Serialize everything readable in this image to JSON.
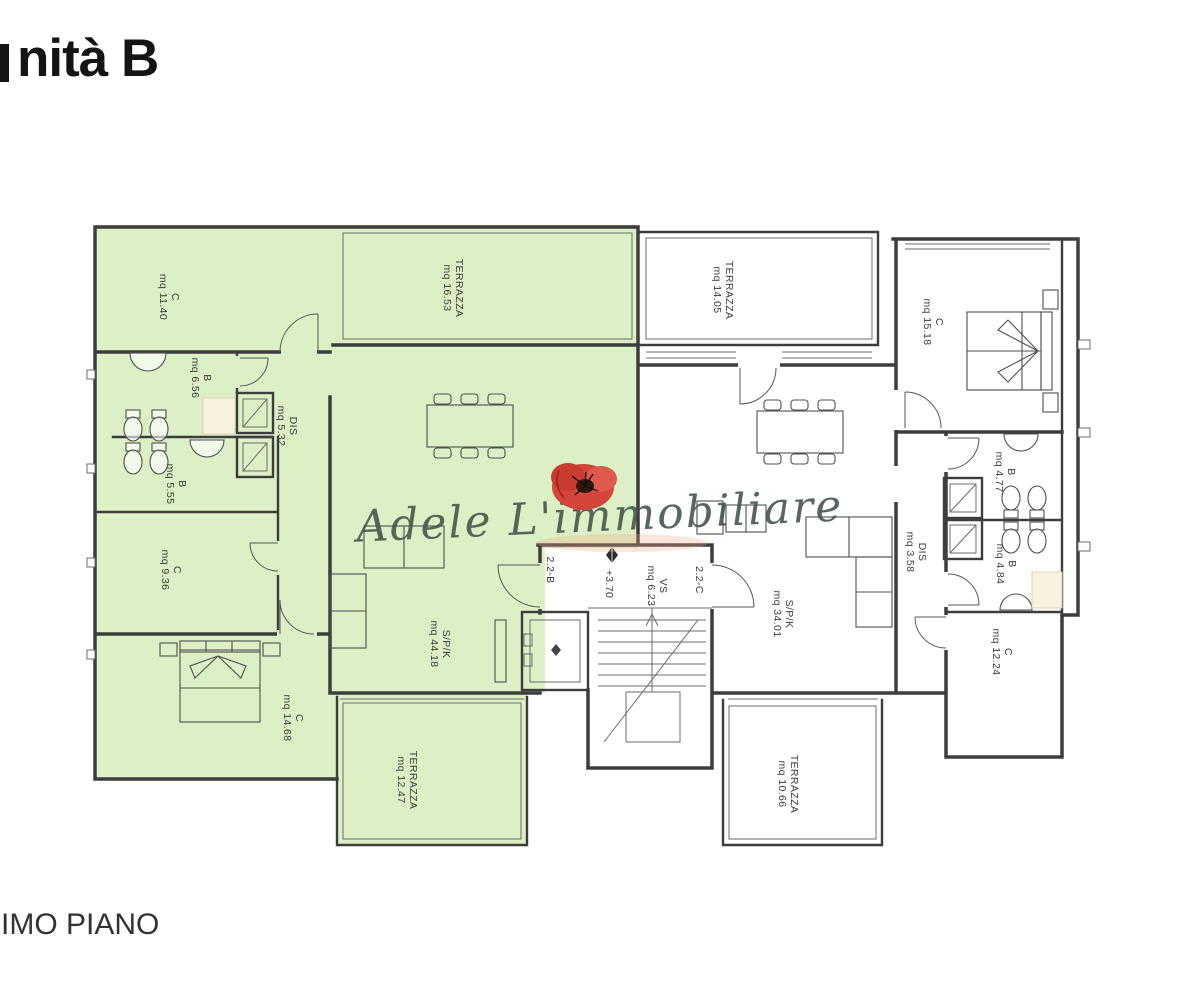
{
  "page": {
    "title": "nità B",
    "footer": "IMO PIANO"
  },
  "watermark": {
    "text": "Adele L'immobiliare"
  },
  "colors": {
    "unit_b_green": "#dcefc5",
    "wall": "#3d3d3d",
    "watermark_text": "#43524a",
    "poppy_red": "#d4453b",
    "shower_cream": "#f8f3e1"
  },
  "plan": {
    "rooms": [
      {
        "id": "c-11-40",
        "unit": "B",
        "label": "C",
        "area": "mq 11.40",
        "x": 170,
        "y": 297
      },
      {
        "id": "terrazza-16-53",
        "unit": "B",
        "label": "TERRAZZA",
        "area": "mq 16.53",
        "x": 454,
        "y": 288
      },
      {
        "id": "terrazza-14-05",
        "unit": "C",
        "label": "TERRAZZA",
        "area": "mq 14.05",
        "x": 724,
        "y": 290
      },
      {
        "id": "c-15-18",
        "unit": "C",
        "label": "C",
        "area": "mq 15.18",
        "x": 934,
        "y": 322
      },
      {
        "id": "b-6-56",
        "unit": "B",
        "label": "B",
        "area": "mq 6.56",
        "x": 202,
        "y": 378
      },
      {
        "id": "dis-5-32",
        "unit": "B",
        "label": "DIS",
        "area": "mq 5.32",
        "x": 288,
        "y": 426
      },
      {
        "id": "b-5-55",
        "unit": "B",
        "label": "B",
        "area": "mq 5.55",
        "x": 177,
        "y": 484
      },
      {
        "id": "c-9-36",
        "unit": "B",
        "label": "C",
        "area": "mq 9.36",
        "x": 172,
        "y": 570
      },
      {
        "id": "c-14-68",
        "unit": "B",
        "label": "C",
        "area": "mq 14.68",
        "x": 294,
        "y": 718
      },
      {
        "id": "spk-44-18",
        "unit": "B",
        "label": "S/P/K",
        "area": "mq 44.18",
        "x": 441,
        "y": 644
      },
      {
        "id": "terrazza-12-47",
        "unit": "B",
        "label": "TERRAZZA",
        "area": "mq 12.47",
        "x": 408,
        "y": 780
      },
      {
        "id": "spk-34-01",
        "unit": "C",
        "label": "S/P/K",
        "area": "mq 34.01",
        "x": 784,
        "y": 614
      },
      {
        "id": "dis-3-58",
        "unit": "C",
        "label": "DIS",
        "area": "mq 3.58",
        "x": 917,
        "y": 552
      },
      {
        "id": "b-4-77",
        "unit": "C",
        "label": "B",
        "area": "mq 4.77",
        "x": 1006,
        "y": 472
      },
      {
        "id": "b-4-84",
        "unit": "C",
        "label": "B",
        "area": "mq 4.84",
        "x": 1007,
        "y": 564
      },
      {
        "id": "c-12-24",
        "unit": "C",
        "label": "C",
        "area": "mq 12.24",
        "x": 1003,
        "y": 652
      },
      {
        "id": "terrazza-10-66",
        "unit": "C",
        "label": "TERRAZZA",
        "area": "mq 10.66",
        "x": 789,
        "y": 784
      },
      {
        "id": "apt-2-2-b",
        "unit": "common",
        "label": "2.2-B",
        "area": null,
        "x": 551,
        "y": 570,
        "size": 12.5
      },
      {
        "id": "level-3-70",
        "unit": "common",
        "label": "+3.70",
        "area": null,
        "x": 610,
        "y": 584,
        "size": 10.5
      },
      {
        "id": "vs-6-23",
        "unit": "common",
        "label": "VS",
        "area": "mq 6.23",
        "x": 658,
        "y": 586
      },
      {
        "id": "apt-2-2-c",
        "unit": "common",
        "label": "2.2-C",
        "area": null,
        "x": 700,
        "y": 580,
        "size": 12.5
      }
    ]
  }
}
